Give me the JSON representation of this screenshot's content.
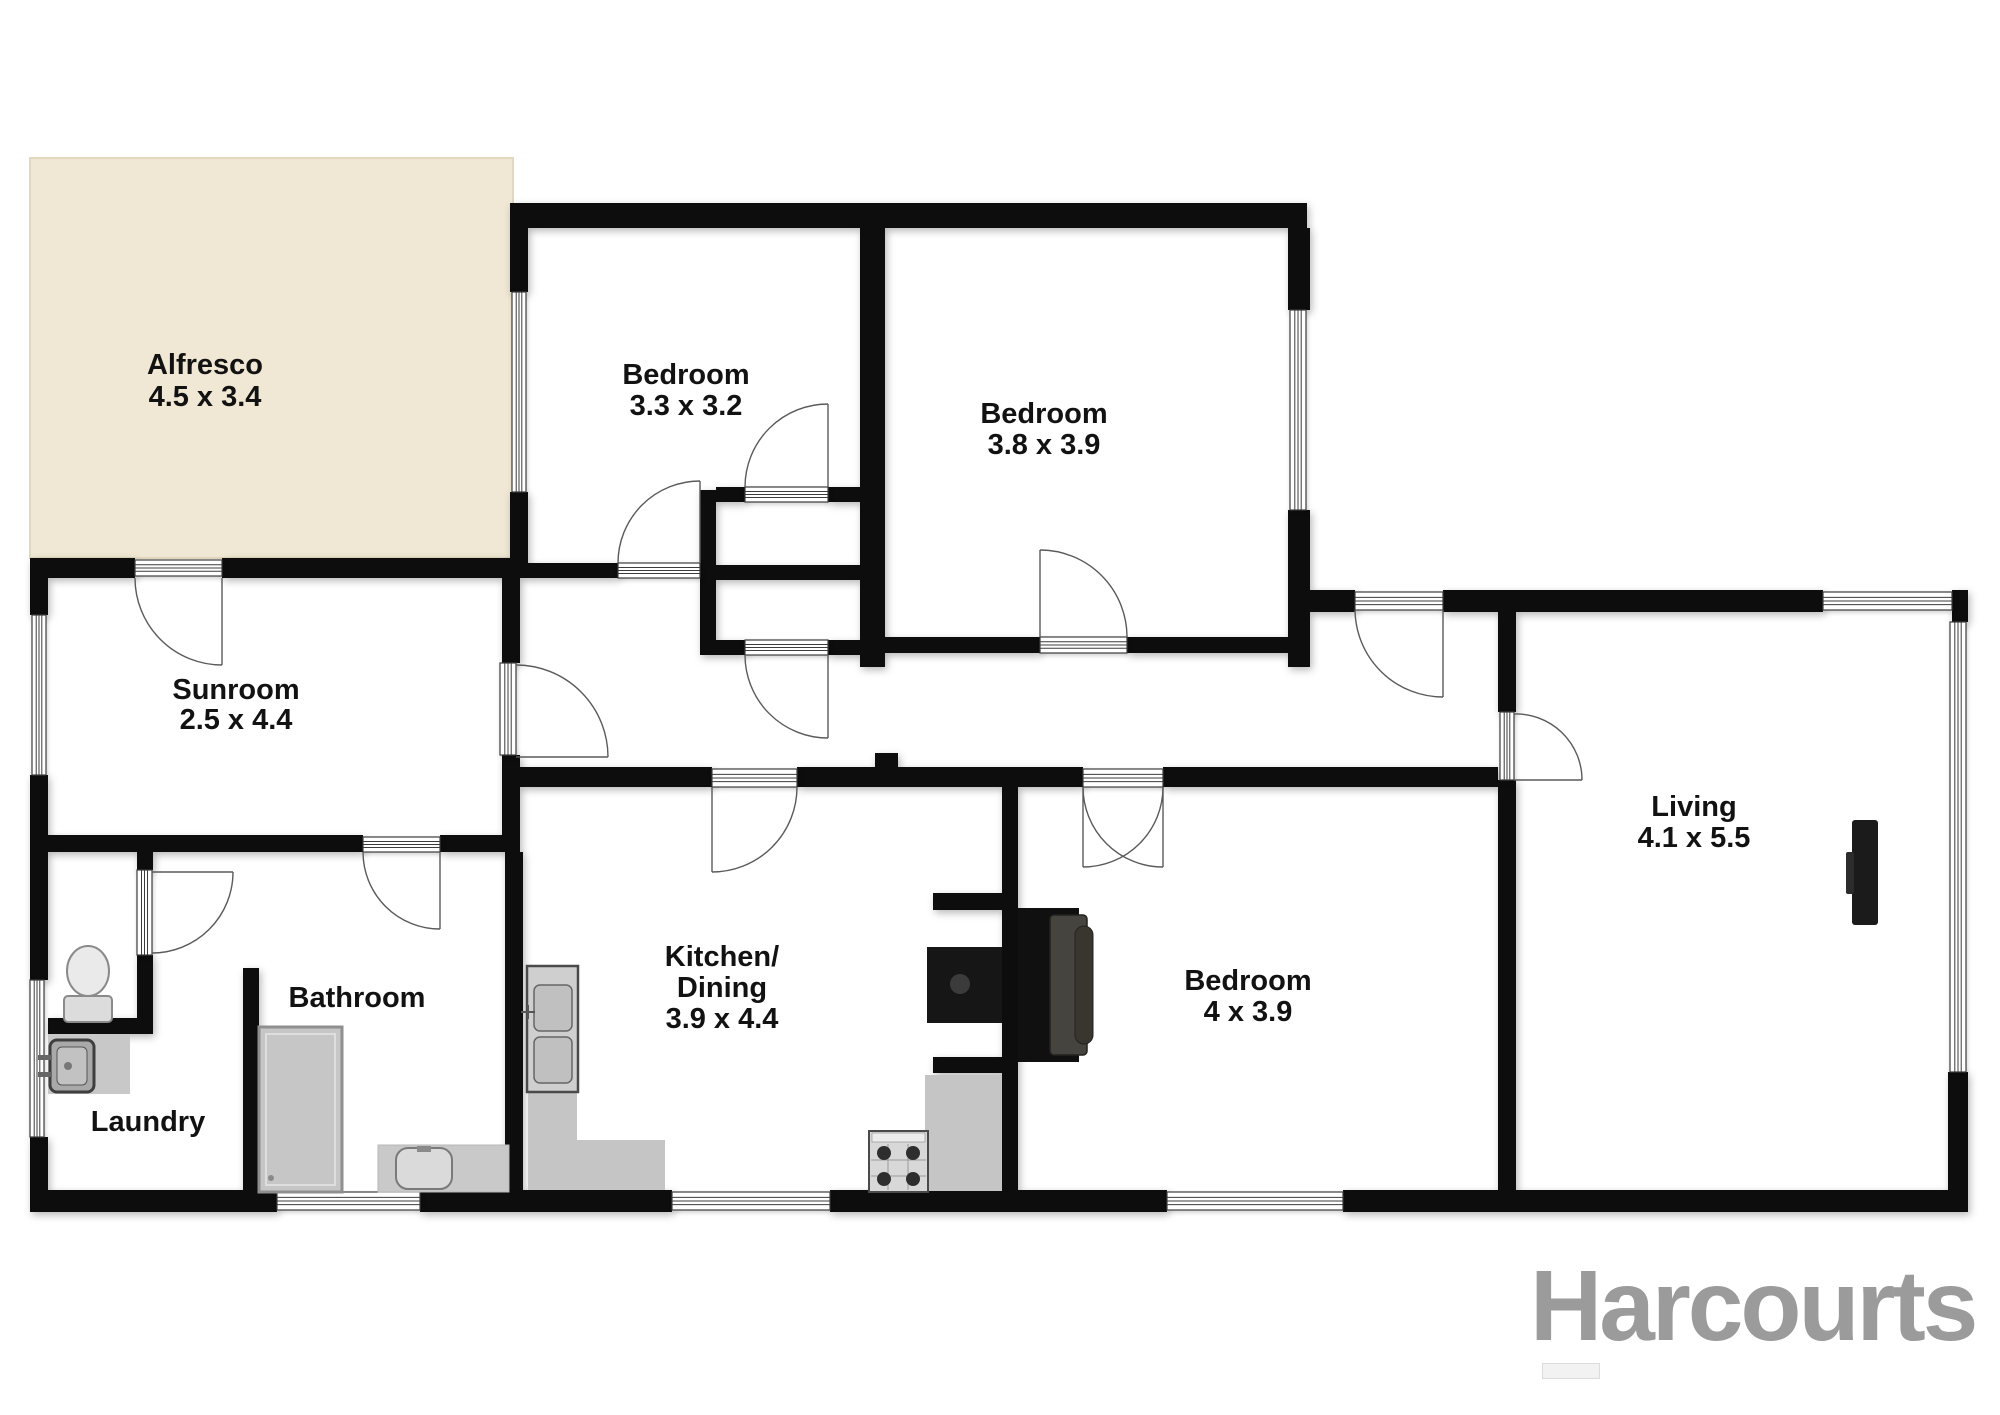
{
  "canvas": {
    "width": 2000,
    "height": 1415,
    "background": "#ffffff"
  },
  "palette": {
    "wall": "#0d0d0d",
    "alfresco_fill": "#f0e8d4",
    "alfresco_edge": "#e2d8bd",
    "frame_fill": "#ffffff",
    "frame_stroke": "#3c3c3c",
    "arc_stroke": "#5a5a5a",
    "label_color": "#121212"
  },
  "logo": {
    "text": "Harcourts",
    "color": "#9b9b9b",
    "bar": {
      "x": 1542,
      "y": 1363,
      "w": 56,
      "h": 14,
      "fill": "#f2f2f2",
      "edge": "#dcdcdc"
    }
  },
  "rooms": [
    {
      "id": "alfresco",
      "lines": [
        "Alfresco",
        "4.5 x 3.4"
      ],
      "cx": 205,
      "by": 374,
      "step": 32
    },
    {
      "id": "bedroom-1",
      "lines": [
        "Bedroom",
        "3.3 x 3.2"
      ],
      "cx": 686,
      "by": 384,
      "step": 31
    },
    {
      "id": "bedroom-2",
      "lines": [
        "Bedroom",
        "3.8 x 3.9"
      ],
      "cx": 1044,
      "by": 423,
      "step": 31
    },
    {
      "id": "sunroom",
      "lines": [
        "Sunroom",
        "2.5 x 4.4"
      ],
      "cx": 236,
      "by": 699,
      "step": 30
    },
    {
      "id": "laundry",
      "lines": [
        "Laundry"
      ],
      "cx": 148,
      "by": 1131,
      "step": 31
    },
    {
      "id": "bathroom",
      "lines": [
        "Bathroom"
      ],
      "cx": 357,
      "by": 1007,
      "step": 31
    },
    {
      "id": "kitchen-dining",
      "lines": [
        "Kitchen/",
        "Dining",
        "3.9 x 4.4"
      ],
      "cx": 722,
      "by": 966,
      "step": 31
    },
    {
      "id": "bedroom-3",
      "lines": [
        "Bedroom",
        "4 x 3.9"
      ],
      "cx": 1248,
      "by": 990,
      "step": 31
    },
    {
      "id": "living",
      "lines": [
        "Living",
        "4.1 x 5.5"
      ],
      "cx": 1694,
      "by": 816,
      "step": 31
    }
  ],
  "plan": {
    "alfresco": {
      "x": 30,
      "y": 158,
      "w": 483,
      "h": 400
    },
    "walls": [
      [
        510,
        203,
        797,
        25
      ],
      [
        510,
        228,
        18,
        64
      ],
      [
        510,
        492,
        18,
        86
      ],
      [
        860,
        228,
        25,
        352
      ],
      [
        1288,
        228,
        22,
        82
      ],
      [
        1288,
        510,
        22,
        157
      ],
      [
        500,
        563,
        118,
        15
      ],
      [
        700,
        490,
        16,
        165
      ],
      [
        716,
        487,
        29,
        15
      ],
      [
        828,
        487,
        32,
        15
      ],
      [
        716,
        565,
        144,
        15
      ],
      [
        716,
        640,
        29,
        15
      ],
      [
        828,
        640,
        32,
        15
      ],
      [
        860,
        580,
        25,
        87
      ],
      [
        885,
        637,
        155,
        16
      ],
      [
        1127,
        637,
        161,
        16
      ],
      [
        1288,
        590,
        67,
        22
      ],
      [
        1443,
        590,
        380,
        22
      ],
      [
        1952,
        590,
        16,
        32
      ],
      [
        1948,
        1072,
        20,
        120
      ],
      [
        30,
        1190,
        247,
        22
      ],
      [
        420,
        1190,
        252,
        22
      ],
      [
        830,
        1190,
        337,
        22
      ],
      [
        1343,
        1190,
        625,
        22
      ],
      [
        30,
        558,
        18,
        57
      ],
      [
        30,
        775,
        18,
        205
      ],
      [
        30,
        1137,
        18,
        60
      ],
      [
        30,
        558,
        105,
        20
      ],
      [
        222,
        558,
        293,
        20
      ],
      [
        502,
        558,
        18,
        105
      ],
      [
        502,
        755,
        18,
        97
      ],
      [
        30,
        835,
        333,
        17
      ],
      [
        440,
        835,
        75,
        17
      ],
      [
        505,
        852,
        18,
        343
      ],
      [
        243,
        968,
        16,
        227
      ],
      [
        137,
        852,
        16,
        18
      ],
      [
        137,
        955,
        16,
        63
      ],
      [
        48,
        1018,
        105,
        16
      ],
      [
        505,
        767,
        207,
        20
      ],
      [
        797,
        767,
        286,
        20
      ],
      [
        1163,
        767,
        335,
        20
      ],
      [
        875,
        753,
        23,
        14
      ],
      [
        1002,
        787,
        16,
        408
      ],
      [
        933,
        893,
        69,
        17
      ],
      [
        933,
        1057,
        69,
        16
      ],
      [
        1498,
        592,
        18,
        120
      ],
      [
        1498,
        780,
        18,
        410
      ]
    ],
    "windows": [
      [
        512,
        292,
        14,
        200
      ],
      [
        1290,
        310,
        16,
        200
      ],
      [
        32,
        615,
        14,
        160
      ],
      [
        30,
        980,
        14,
        157
      ],
      [
        277,
        1192,
        143,
        18
      ],
      [
        672,
        1192,
        158,
        18
      ],
      [
        1167,
        1192,
        176,
        18
      ],
      [
        1823,
        592,
        129,
        18
      ],
      [
        1950,
        622,
        16,
        450
      ]
    ],
    "door_frames": [
      [
        135,
        560,
        87,
        16
      ],
      [
        618,
        563,
        82,
        15
      ],
      [
        745,
        487,
        83,
        15
      ],
      [
        745,
        640,
        83,
        15
      ],
      [
        1040,
        637,
        87,
        16
      ],
      [
        712,
        769,
        85,
        18
      ],
      [
        1083,
        769,
        80,
        18
      ],
      [
        363,
        837,
        77,
        15
      ],
      [
        137,
        870,
        15,
        85
      ],
      [
        500,
        663,
        16,
        92
      ],
      [
        1355,
        592,
        88,
        18
      ],
      [
        1500,
        712,
        14,
        68
      ]
    ],
    "door_arcs": [
      {
        "hinge": [
          222,
          578
        ],
        "closed": [
          135,
          578
        ],
        "tip": [
          222,
          665
        ]
      },
      {
        "hinge": [
          700,
          563
        ],
        "closed": [
          618,
          563
        ],
        "tip": [
          700,
          481
        ]
      },
      {
        "hinge": [
          828,
          487
        ],
        "closed": [
          745,
          487
        ],
        "tip": [
          828,
          404
        ]
      },
      {
        "hinge": [
          828,
          655
        ],
        "closed": [
          745,
          655
        ],
        "tip": [
          828,
          738
        ]
      },
      {
        "hinge": [
          1040,
          637
        ],
        "closed": [
          1127,
          637
        ],
        "tip": [
          1040,
          550
        ]
      },
      {
        "hinge": [
          712,
          787
        ],
        "closed": [
          797,
          787
        ],
        "tip": [
          712,
          872
        ]
      },
      {
        "hinge": [
          1083,
          787
        ],
        "closed": [
          1163,
          787
        ],
        "tip": [
          1083,
          867
        ]
      },
      {
        "hinge": [
          1163,
          787
        ],
        "closed": [
          1083,
          787
        ],
        "tip": [
          1163,
          867
        ]
      },
      {
        "hinge": [
          440,
          852
        ],
        "closed": [
          363,
          852
        ],
        "tip": [
          440,
          929
        ]
      },
      {
        "hinge": [
          152,
          872
        ],
        "closed": [
          152,
          953
        ],
        "tip": [
          233,
          872
        ]
      },
      {
        "hinge": [
          516,
          757
        ],
        "closed": [
          516,
          665
        ],
        "tip": [
          608,
          757
        ]
      },
      {
        "hinge": [
          1443,
          610
        ],
        "closed": [
          1355,
          610
        ],
        "tip": [
          1443,
          697
        ]
      },
      {
        "hinge": [
          1514,
          780
        ],
        "closed": [
          1514,
          714
        ],
        "tip": [
          1582,
          780
        ]
      }
    ],
    "fixtures": [
      {
        "name": "toilet-tank",
        "shape": "rect",
        "d": [
          64,
          996,
          48,
          26
        ],
        "rx": 4,
        "fill": "#dcdcdc",
        "stroke": "#8a8a8a",
        "sw": 2
      },
      {
        "name": "toilet-bowl",
        "shape": "ellipse",
        "d": [
          88,
          971,
          21,
          25
        ],
        "fill": "#eaeaea",
        "stroke": "#8a8a8a",
        "sw": 2
      },
      {
        "name": "laundry-counter",
        "shape": "rect",
        "d": [
          48,
          1034,
          82,
          60
        ],
        "fill": "#c8c8c8"
      },
      {
        "name": "laundry-sink",
        "shape": "rect",
        "d": [
          50,
          1040,
          44,
          52
        ],
        "rx": 7,
        "fill": "#a9a9a9",
        "stroke": "#3f3f3f",
        "sw": 3
      },
      {
        "name": "laundry-sink-basin",
        "shape": "rect",
        "d": [
          57,
          1047,
          30,
          38
        ],
        "rx": 5,
        "fill": "#c2c2c2",
        "stroke": "#555555",
        "sw": 1
      },
      {
        "name": "laundry-faucet-a",
        "shape": "rect",
        "d": [
          38,
          1055,
          14,
          5
        ],
        "fill": "#666666"
      },
      {
        "name": "laundry-faucet-b",
        "shape": "rect",
        "d": [
          38,
          1072,
          14,
          5
        ],
        "fill": "#666666"
      },
      {
        "name": "laundry-drain",
        "shape": "circle",
        "d": [
          68,
          1066,
          4
        ],
        "fill": "#787878"
      },
      {
        "name": "shower-base",
        "shape": "rect",
        "d": [
          259,
          1027,
          83,
          165
        ],
        "fill": "#c6c6c6",
        "stroke": "#8f8f8f",
        "sw": 3
      },
      {
        "name": "shower-inner",
        "shape": "rect",
        "d": [
          266,
          1034,
          69,
          151
        ],
        "fill": "none",
        "stroke": "#dedede",
        "sw": 2
      },
      {
        "name": "shower-drain",
        "shape": "circle",
        "d": [
          271,
          1178,
          3
        ],
        "fill": "#8a8a8a"
      },
      {
        "name": "vanity-counter",
        "shape": "rect",
        "d": [
          378,
          1145,
          131,
          47
        ],
        "fill": "#c9c9c9",
        "stroke": "#b7b7b7",
        "sw": 1
      },
      {
        "name": "vanity-basin",
        "shape": "rect",
        "d": [
          396,
          1148,
          56,
          41
        ],
        "rx": 12,
        "fill": "#dadada",
        "stroke": "#7a7a7a",
        "sw": 2
      },
      {
        "name": "vanity-tap",
        "shape": "rect",
        "d": [
          417,
          1146,
          14,
          6
        ],
        "fill": "#8a8a8a"
      },
      {
        "name": "kitchen-counter-l",
        "shape": "path",
        "d": "M528,966 h49 v174 h88 v50 h-137 Z",
        "fill": "#c5c5c5"
      },
      {
        "name": "kitchen-sink-unit",
        "shape": "rect",
        "d": [
          527,
          966,
          51,
          126
        ],
        "fill": "#cfcfcf",
        "stroke": "#4a4a4a",
        "sw": 2.5
      },
      {
        "name": "kitchen-sink-basin-a",
        "shape": "rect",
        "d": [
          534,
          985,
          38,
          46
        ],
        "rx": 6,
        "fill": "#c0c0c0",
        "stroke": "#666666",
        "sw": 1.5
      },
      {
        "name": "kitchen-sink-basin-b",
        "shape": "rect",
        "d": [
          534,
          1037,
          38,
          46
        ],
        "rx": 6,
        "fill": "#c0c0c0",
        "stroke": "#666666",
        "sw": 1.5
      },
      {
        "name": "kitchen-faucet",
        "shape": "path",
        "d": "M521,1012 h14 M528,1005 v14",
        "fill": "none",
        "stroke": "#555555",
        "sw": 2
      },
      {
        "name": "kitchen-counter-r",
        "shape": "rect",
        "d": [
          925,
          1075,
          77,
          116
        ],
        "fill": "#c5c5c5"
      },
      {
        "name": "stove-body",
        "shape": "rect",
        "d": [
          869,
          1131,
          59,
          61
        ],
        "fill": "#d8d8d8",
        "stroke": "#4a4a4a",
        "sw": 2
      },
      {
        "name": "stove-band",
        "shape": "rect",
        "d": [
          872,
          1133,
          53,
          9
        ],
        "fill": "#ececec",
        "stroke": "#888888",
        "sw": 0.6
      },
      {
        "name": "stove-grid",
        "shape": "path",
        "d": "M888,1144 V1190 M908,1144 V1190 M871,1160 H926 M871,1176 H926",
        "fill": "none",
        "stroke": "#9a9a9a",
        "sw": 1
      },
      {
        "name": "stove-burner-1",
        "shape": "circle",
        "d": [
          884,
          1153,
          7
        ],
        "fill": "#2e2e2e"
      },
      {
        "name": "stove-burner-2",
        "shape": "circle",
        "d": [
          913,
          1153,
          7
        ],
        "fill": "#2e2e2e"
      },
      {
        "name": "stove-burner-3",
        "shape": "circle",
        "d": [
          884,
          1179,
          7
        ],
        "fill": "#2e2e2e"
      },
      {
        "name": "stove-burner-4",
        "shape": "circle",
        "d": [
          913,
          1179,
          7
        ],
        "fill": "#2e2e2e"
      },
      {
        "name": "fireplace-firebox",
        "shape": "rect",
        "d": [
          927,
          947,
          75,
          76
        ],
        "fill": "#161616"
      },
      {
        "name": "fireplace-ring",
        "shape": "circle",
        "d": [
          960,
          984,
          10
        ],
        "fill": "#3b3b3b"
      },
      {
        "name": "fireplace-back",
        "shape": "rect",
        "d": [
          1018,
          908,
          61,
          154
        ],
        "fill": "#101010"
      },
      {
        "name": "fireplace-panel",
        "shape": "rect",
        "d": [
          1050,
          915,
          37,
          140
        ],
        "rx": 4,
        "fill": "#46443f",
        "stroke": "#23221f",
        "sw": 1.5
      },
      {
        "name": "fireplace-bulge",
        "shape": "rect",
        "d": [
          1075,
          926,
          18,
          118
        ],
        "rx": 9,
        "fill": "#38362f",
        "stroke": "#23221f",
        "sw": 1
      },
      {
        "name": "tv-panel",
        "shape": "rect",
        "d": [
          1852,
          820,
          26,
          105
        ],
        "rx": 3,
        "fill": "#1b1b1b"
      },
      {
        "name": "tv-mount",
        "shape": "rect",
        "d": [
          1846,
          852,
          8,
          42
        ],
        "rx": 2,
        "fill": "#2c2c2c"
      }
    ]
  }
}
